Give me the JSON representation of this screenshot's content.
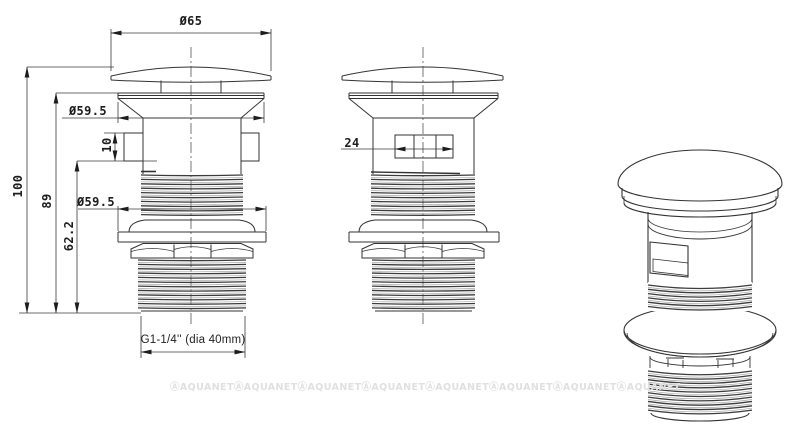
{
  "document": {
    "type": "technical-drawing",
    "subject": "pop-up basin waste drain valve",
    "background_color": "#ffffff",
    "line_color": "#333333",
    "thread_line_color": "#3c3c3c"
  },
  "views": {
    "front_left": "front view with section dimensions",
    "front_middle": "front view rotated 90 degrees",
    "isometric": "3d line rendering"
  },
  "dimensions": {
    "cap_diameter": "Ø65",
    "flange_diameter_top": "Ø59.5",
    "slot_height": "10",
    "overall_height": "100",
    "height_flange_to_bottom": "89",
    "washer_diameter": "Ø59.5",
    "height_slot_to_bottom": "62.2",
    "overflow_window_width": "24",
    "thread_spec": "G1-1/4'' (dia 40mm)"
  },
  "watermark": {
    "text": "ⒶAQUANET",
    "count": 8,
    "color": "#e0e0e0"
  }
}
